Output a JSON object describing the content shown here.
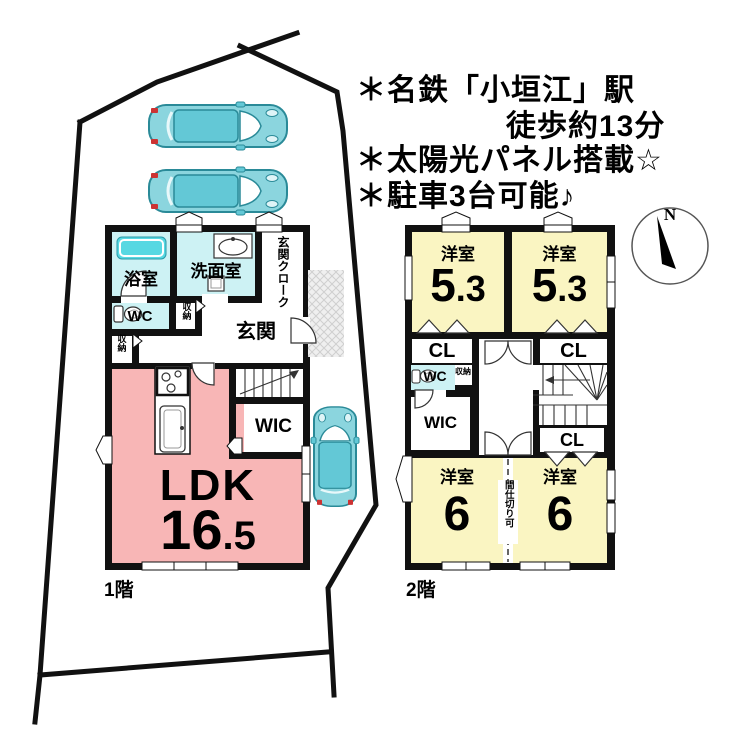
{
  "notes": {
    "line1": "＊名鉄「小垣江」駅",
    "line2": "徒歩約13分",
    "line3": "＊太陽光パネル搭載☆",
    "line4": "＊駐車3台可能♪"
  },
  "compass": {
    "north": "N"
  },
  "floor1": {
    "name": "1階",
    "bath": "浴室",
    "washroom": "洗面室",
    "cloak_col1": "玄関",
    "cloak_col2": "クローク",
    "wc": "WC",
    "storage_a": "収納",
    "storage_b": "収納",
    "entrance": "玄関",
    "ldk_label": "LDK",
    "ldk_num": "16",
    "ldk_dec": ".5",
    "wic": "WIC"
  },
  "floor2": {
    "name": "2階",
    "bed1_label": "洋室",
    "bed1_num": "5",
    "bed1_dec": ".3",
    "bed2_label": "洋室",
    "bed2_num": "5",
    "bed2_dec": ".3",
    "bed3_label": "洋室",
    "bed3_num": "6",
    "bed4_label": "洋室",
    "bed4_num": "6",
    "cl_a": "CL",
    "cl_b": "CL",
    "cl_c": "CL",
    "wc": "WC",
    "storage": "収納",
    "wic": "WIC",
    "partition": "間仕切り可"
  },
  "colors": {
    "wall": "#111111",
    "ldk_pink": "#f8b6b6",
    "bedroom_yellow": "#faf5c2",
    "wet_area_cyan": "#cdf2f4",
    "bathtub_cyan": "#57d8e2",
    "car_teal": "#8bd5de"
  }
}
